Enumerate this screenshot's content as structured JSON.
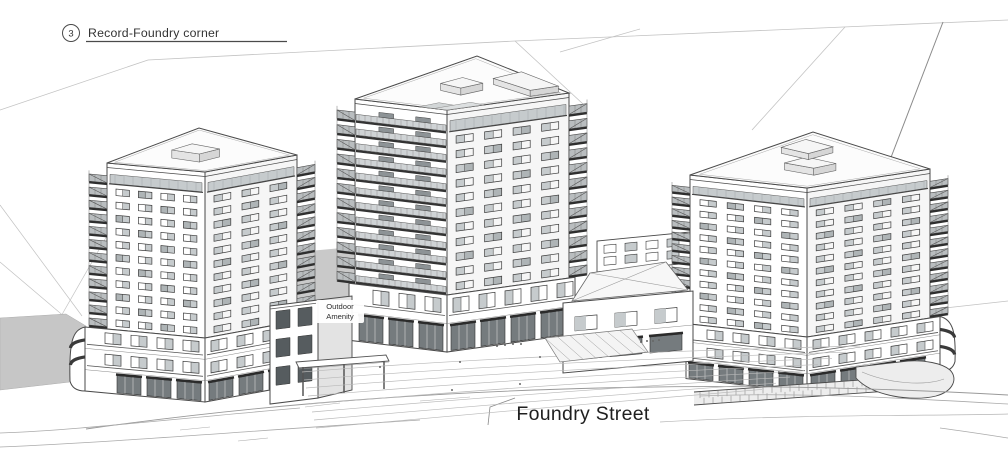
{
  "annotations": {
    "view_ref": {
      "number": "3",
      "label": "Record-Foundry corner"
    },
    "amenity": {
      "line1": "Outdoor",
      "line2": "Amenity"
    },
    "street": {
      "label": "Foundry Street"
    }
  },
  "colors": {
    "line": "#4a4a4a",
    "line_soft": "#8a8a8a",
    "faint": "#c2c2c2",
    "glass": "#c6cbcd",
    "glass_dark": "#9fa6a9",
    "slab": "#2e2e2e",
    "hill": "#c6c6c6",
    "deck": "#c9c9c9",
    "roof": "#fcfcfc",
    "stone": "#ededed",
    "storefront": "#757b7e",
    "text": "#2a2a2a"
  },
  "scene": {
    "towers": [
      {
        "id": "left",
        "cx": 205,
        "y_top": 172,
        "y_bottom": 338,
        "floors": 12,
        "left": {
          "w": 98,
          "rise": 9,
          "style": "windows",
          "cols": 4,
          "stack": true
        },
        "right": {
          "w": 92,
          "rise": 17,
          "style": "windows",
          "cols": 3,
          "stack": true
        },
        "balcony_depth": 18,
        "roof_depth": 18,
        "roof_boxes": [
          {
            "a0": 0.34,
            "b0": 0.3,
            "a1": 0.62,
            "b1": 0.52,
            "h": 8
          }
        ],
        "terraces": false,
        "podium": {
          "y_ground": 402,
          "ext_left": 22,
          "ext_right": 34,
          "floors": 3,
          "round": "left"
        }
      },
      {
        "id": "center",
        "cx": 447,
        "y_top": 110,
        "y_bottom": 295,
        "floors": 12,
        "left": {
          "w": 92,
          "rise": 11,
          "style": "balconies",
          "cols": 4,
          "stack": true
        },
        "right": {
          "w": 122,
          "rise": 17,
          "style": "windows",
          "cols": 4,
          "stack": true
        },
        "balcony_depth": 18,
        "roof_depth": 26,
        "roof_boxes": [
          {
            "a0": 0.38,
            "b0": 0.4,
            "a1": 0.6,
            "b1": 0.58,
            "h": 7
          },
          {
            "a0": 0.05,
            "b0": 0.72,
            "a1": 0.45,
            "b1": 0.95,
            "h": 6
          }
        ],
        "terraces": true,
        "podium": {
          "y_ground": 352,
          "ext_left": 6,
          "ext_right": 6,
          "floors": 2,
          "round": null
        }
      },
      {
        "id": "right",
        "cx": 807,
        "y_top": 188,
        "y_bottom": 337,
        "floors": 12,
        "left": {
          "w": 117,
          "rise": 13,
          "style": "windows",
          "cols": 4,
          "stack": true
        },
        "right": {
          "w": 123,
          "rise": 19,
          "style": "windows",
          "cols": 4,
          "stack": true
        },
        "balcony_depth": 18,
        "roof_depth": 24,
        "roof_boxes": [
          {
            "a0": 0.3,
            "b0": 0.34,
            "a1": 0.55,
            "b1": 0.52,
            "h": 7
          },
          {
            "a0": 0.62,
            "b0": 0.6,
            "a1": 0.85,
            "b1": 0.8,
            "h": 6
          }
        ],
        "terraces": false,
        "podium": {
          "y_ground": 392,
          "ext_left": 4,
          "ext_right": 10,
          "floors": 3,
          "round": "right"
        }
      }
    ]
  }
}
